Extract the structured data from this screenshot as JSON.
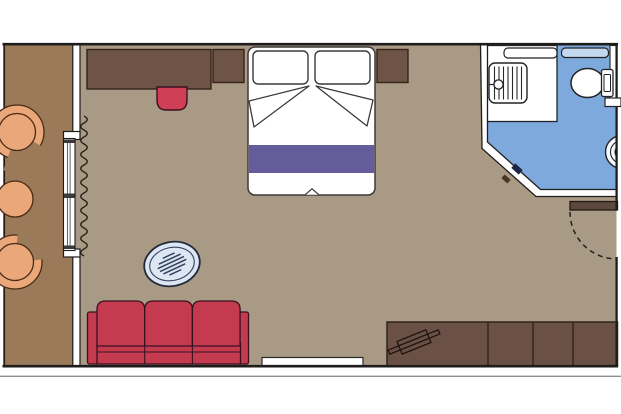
{
  "title": "cabin-floor-plan",
  "colors": {
    "background": "#ffffff",
    "wall_line": "#1f1d1b",
    "wall_fill": "#ffffff",
    "room_floor": "#a89a85",
    "balcony_floor": "#9b7a5a",
    "bathroom_floor": "#7ea9dd",
    "shower_floor": "#ffffff",
    "wood_dark": "#6e5347",
    "wardrobe_wood": "#6b5045",
    "entry_door_wood": "#5c483c",
    "sofa_red": "#c43b4f",
    "stool_red": "#ce3e55",
    "bed_white": "#ffffff",
    "bed_stripe": "#655c9b",
    "chair_peach": "#e9a77a",
    "table_fill": "#dce7f3",
    "table_line": "#33415e",
    "shelf_blue": "#c3d8ef",
    "sink_fill": "#f4f8fc",
    "handle_navy": "#1d2742",
    "handle_brown": "#4a3526",
    "outer_line_gray": "#8e8e8e",
    "glass_line": "#4a4a4a",
    "tick_dark": "#3a3a3a"
  },
  "plan": {
    "rooms": [
      "balcony",
      "cabin",
      "bathroom"
    ],
    "furniture": [
      "balcony-armchair",
      "balcony-side-table",
      "balcony-armchair",
      "sliding-glass-door",
      "curtain",
      "desk",
      "desk-stool",
      "nightstand-left",
      "double-bed",
      "nightstand-right",
      "glass-coffee-table",
      "sofa",
      "wardrobe-cabinets",
      "luggage-rack",
      "shower",
      "shower-shelf",
      "towel-shelf",
      "toilet",
      "washbasin",
      "bathroom-sliding-door",
      "entrance-door"
    ]
  }
}
